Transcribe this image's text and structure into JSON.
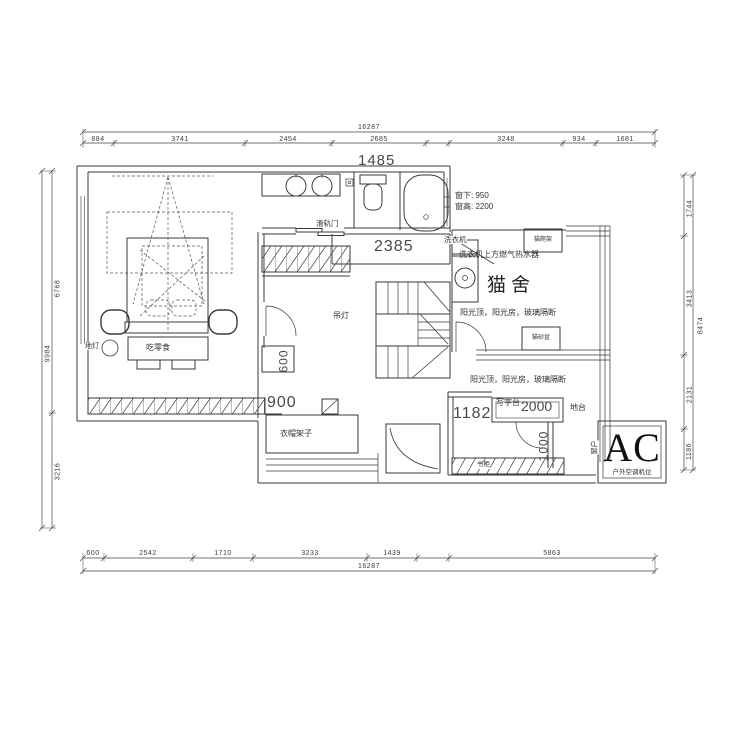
{
  "drawing": {
    "dimensions": {
      "top": {
        "total": "16287",
        "segments": [
          "884",
          "3741",
          "2454",
          "2685",
          "3248",
          "934",
          "1681"
        ]
      },
      "bottom": {
        "total": "16287",
        "segments": [
          "600",
          "2542",
          "1710",
          "3233",
          "1439",
          "5863"
        ]
      },
      "left": {
        "total": "9984",
        "segments": [
          "6768",
          "3216"
        ]
      },
      "right": {
        "total": "8474",
        "segments": [
          "1744",
          "3413",
          "2131",
          "1186"
        ]
      }
    },
    "inline_dims": {
      "entry": "1485",
      "hall": "2385",
      "cabinet": "900",
      "closet": "600",
      "desk_room": "1182",
      "desk_length": "2000",
      "door_clear": "1000"
    },
    "annotations": {
      "window_note1": "窗下: 950",
      "window_note2": "窗高: 2200",
      "sliding_door": "滑轨门",
      "washer": "洗衣机",
      "heater": "洗衣机上方燃气热水器",
      "cat_house": "猫舍",
      "cat_tree": "猫爬架",
      "litter_box": "猫砂盆",
      "sunroom1": "阳光顶，阳光房，玻璃隔断",
      "sunroom2": "阳光顶，阳光房，玻璃隔断",
      "pendant": "吊灯",
      "floor_lamp": "地灯",
      "snack": "吃零食",
      "coat_rack": "衣帽架子",
      "desk": "写字台",
      "platform": "地台",
      "window_v": "窗户",
      "ac": "AC",
      "ac_note": "户外空调机位",
      "bookcase": "书柜"
    }
  }
}
